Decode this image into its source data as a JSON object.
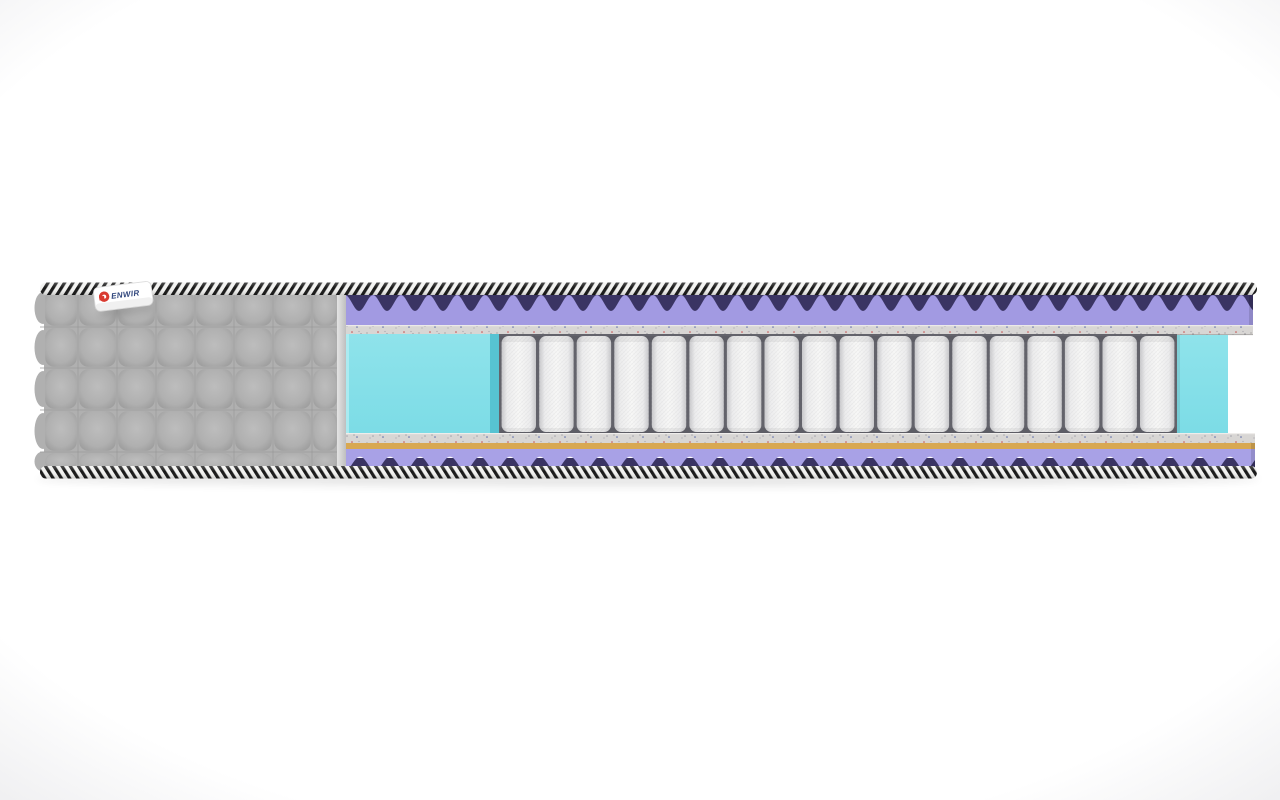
{
  "page": {
    "background_center": "#ffffff",
    "background_edge": "#eeeef0",
    "shadow_color": "#2a2a2a"
  },
  "mattress": {
    "description": "cutaway-cross-section-of-pocket-spring-mattress",
    "label": {
      "text": "ENWIR",
      "background": "#ffffff",
      "text_color": "#31477d",
      "logo_color": "#d93b31",
      "logo_icon": "denwir-logo-mark"
    },
    "piping": {
      "light": "#f2f2f0",
      "dark": "#161616"
    },
    "cover": {
      "color": "#b0b0b0",
      "puff_center": "#bdbdbd",
      "puff_edge": "#979797",
      "seam_color": "#9a9a9a",
      "cut_edge_color": "#d6d6d6",
      "quilt_rows": 5,
      "quilt_cols": 8
    },
    "layers": [
      {
        "name": "wave-foam-top",
        "color": "#a29ae2",
        "cavity_color": "#3a3463"
      },
      {
        "name": "felt-top",
        "color": "#d8d6d4",
        "speckles": [
          "#b4b2b1",
          "#a3a2ab",
          "#c44f4f",
          "#5b6aa8",
          "#8b8a93"
        ]
      },
      {
        "name": "pocket-springs",
        "color": "#f4f4f3",
        "edge_color": "#c6c6c9",
        "gap_color": "#63636b",
        "count": 18
      },
      {
        "name": "side-support-foam",
        "color": "#7cdce6",
        "side_face_color": "#57c3d2",
        "highlight": "#b4edf2"
      },
      {
        "name": "felt-bottom",
        "color": "#d8d6d4",
        "speckles": [
          "#b4b2b1",
          "#a3a2ab",
          "#c44f4f",
          "#5b6aa8",
          "#8b8a93"
        ]
      },
      {
        "name": "coir",
        "color": "#d8a852",
        "shade_color": "#b98c3e"
      },
      {
        "name": "wave-foam-bottom",
        "color": "#a8a1e6",
        "cavity_color": "#3a3463"
      }
    ]
  }
}
